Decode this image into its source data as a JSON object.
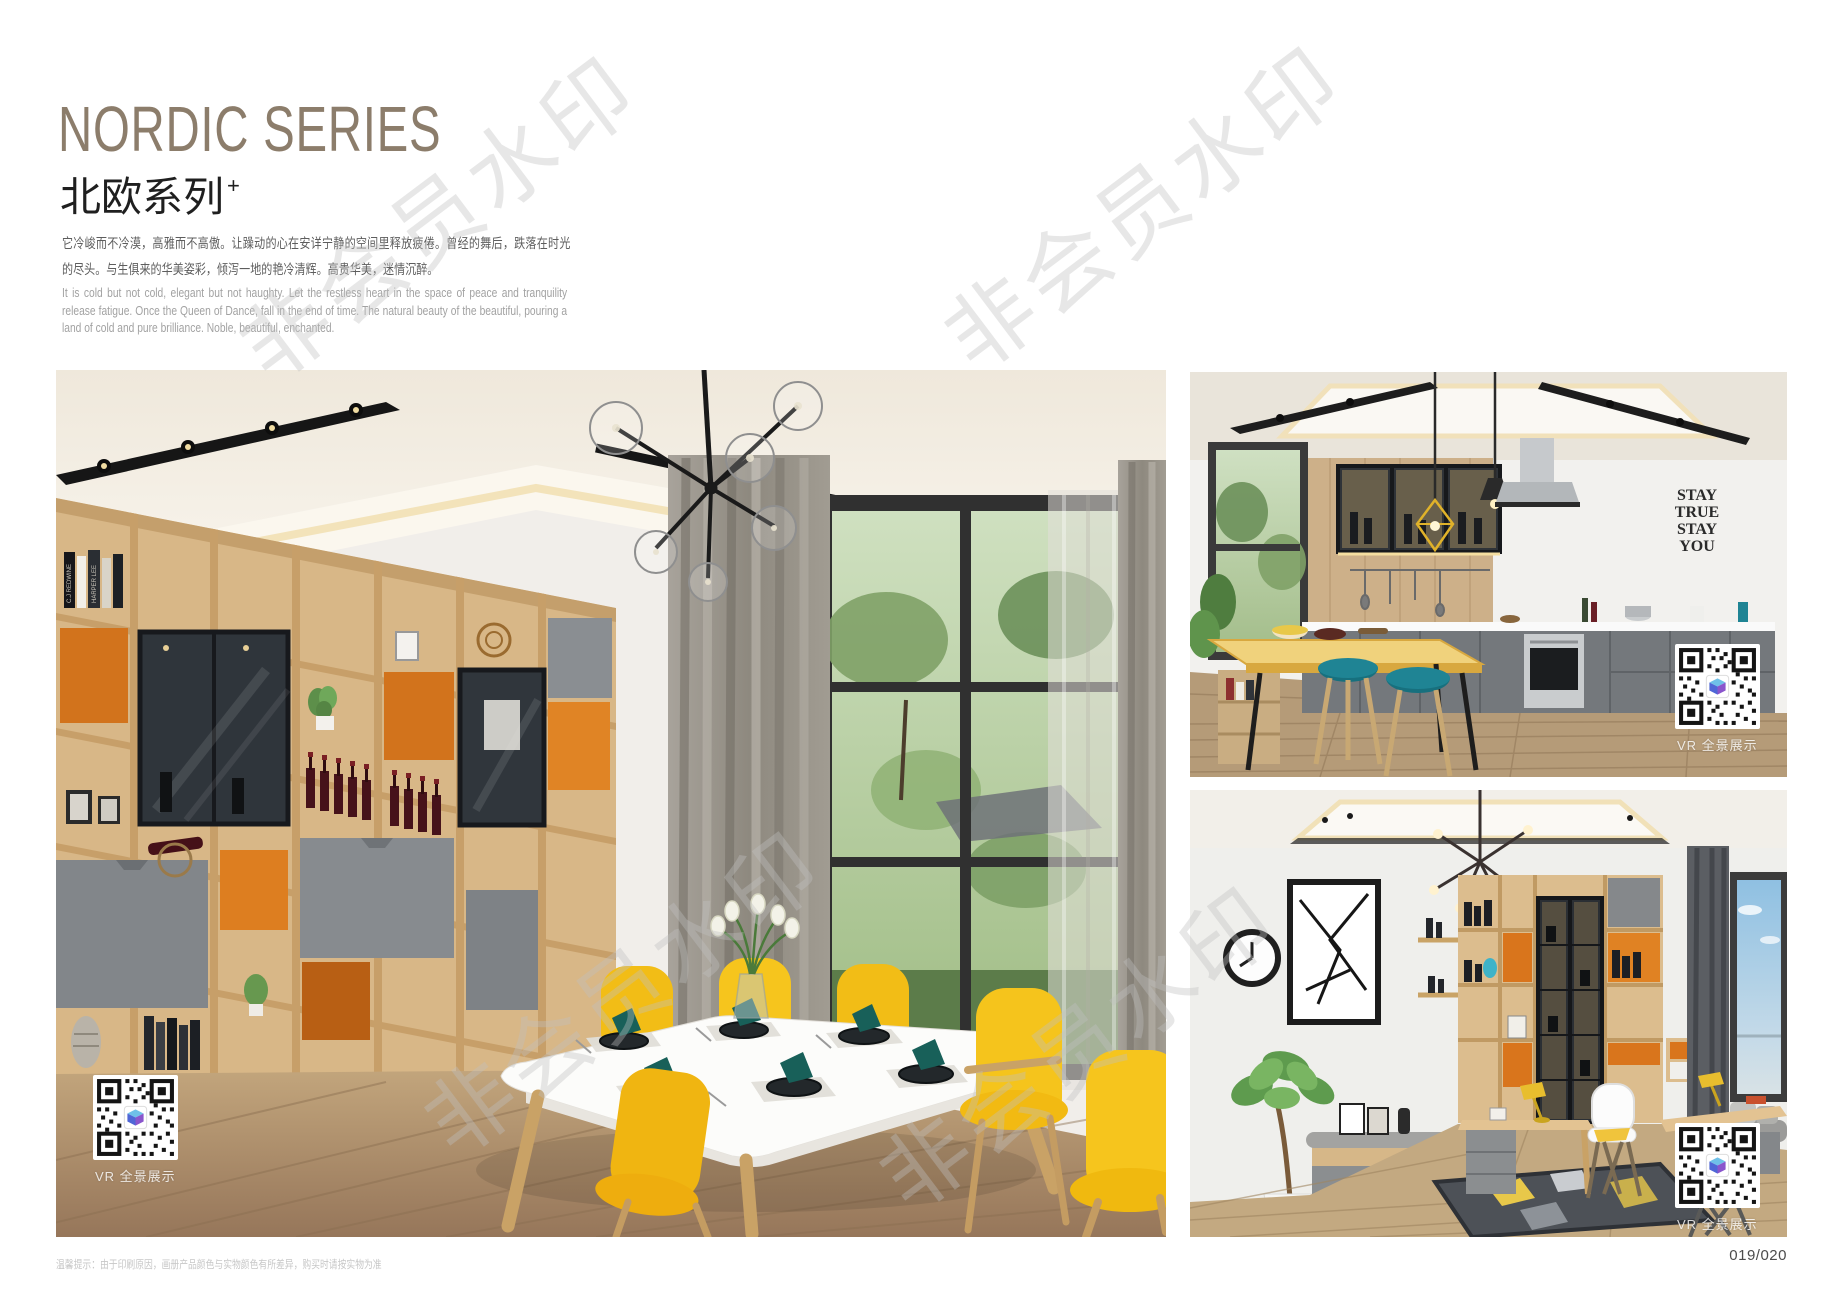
{
  "page": {
    "page_number": "019/020",
    "footer_note": "温馨提示：由于印刷原因，画册产品颜色与实物颜色有所差异，购买时请按实物为准"
  },
  "header": {
    "title_en": "NORDIC SERIES",
    "title_zh": "北欧系列",
    "title_superscript": "+",
    "intro_zh": "它冷峻而不冷漠，高雅而不高傲。让躁动的心在安详宁静的空间里释放疲倦。曾经的舞后，跌落在时光的尽头。与生俱来的华美姿彩，倾泻一地的艳冷清辉。高贵华美，迷情沉醉。",
    "intro_en": "It is cold but not cold, elegant but not haughty. Let the restless heart in the space of peace and tranquility release fatigue. Once the Queen of Dance, fall in the end of time. The natural beauty of the beautiful, pouring a land of cold and pure brilliance. Noble, beautiful, enchanted.",
    "title_color": "#8c7d6b"
  },
  "watermark": {
    "text": "非会员水印"
  },
  "photos": {
    "dining": {
      "vr_label": "VR 全景展示",
      "book_spine_1": "C.J REDWINE",
      "book_spine_2": "HARPER LEE"
    },
    "kitchen": {
      "vr_label": "VR 全景展示",
      "wall_lines": [
        "STAY",
        "TRUE",
        "STAY",
        "YOU"
      ]
    },
    "study": {
      "vr_label": "VR 全景展示"
    }
  },
  "colors": {
    "accent_yellow": "#f5c41c",
    "accent_orange": "#d9731a",
    "accent_teal": "#1f8494",
    "wood": "#d8b787",
    "gray_door": "#85888b"
  }
}
